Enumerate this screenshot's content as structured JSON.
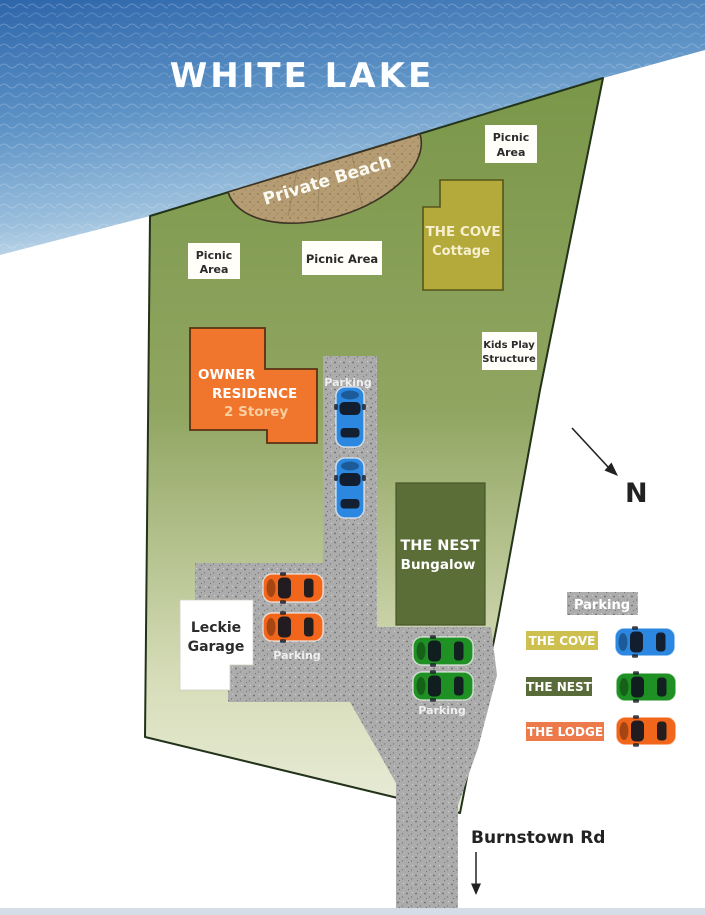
{
  "lake": {
    "title": "WHITE LAKE"
  },
  "beach": {
    "label": "Private Beach"
  },
  "picnic": {
    "top_right": {
      "line1": "Picnic",
      "line2": "Area"
    },
    "left": {
      "line1": "Picnic",
      "line2": "Area"
    },
    "middle": {
      "label": "Picnic Area"
    }
  },
  "kids_play": {
    "line1": "Kids Play",
    "line2": "Structure"
  },
  "buildings": {
    "cove": {
      "name": "THE COVE",
      "type": "Cottage",
      "color": "#b4a93b"
    },
    "owner": {
      "line1": "OWNER",
      "line2": "RESIDENCE",
      "line3": "2 Storey",
      "color": "#f0752d"
    },
    "nest": {
      "name": "THE NEST",
      "type": "Bungalow",
      "color": "#5c6e38"
    },
    "garage": {
      "line1": "Leckie",
      "line2": "Garage"
    }
  },
  "parking_lots": {
    "cove_lot": "Parking",
    "lodge_lot": "Parking",
    "nest_lot": "Parking"
  },
  "cars": {
    "blue": "#2b87e0",
    "green": "#1f9023",
    "orange": "#f2661c"
  },
  "compass": {
    "north": "N"
  },
  "road": {
    "name": "Burnstown Rd"
  },
  "legend": {
    "parking_chip": "Parking",
    "items": [
      {
        "label": "THE COVE",
        "chip": "#cdc04e",
        "car": "#2b87e0"
      },
      {
        "label": "THE NEST",
        "chip": "#5a6b3a",
        "car": "#1f9023"
      },
      {
        "label": "THE LODGE",
        "chip": "#ec7a4b",
        "car": "#f2661c"
      }
    ]
  }
}
